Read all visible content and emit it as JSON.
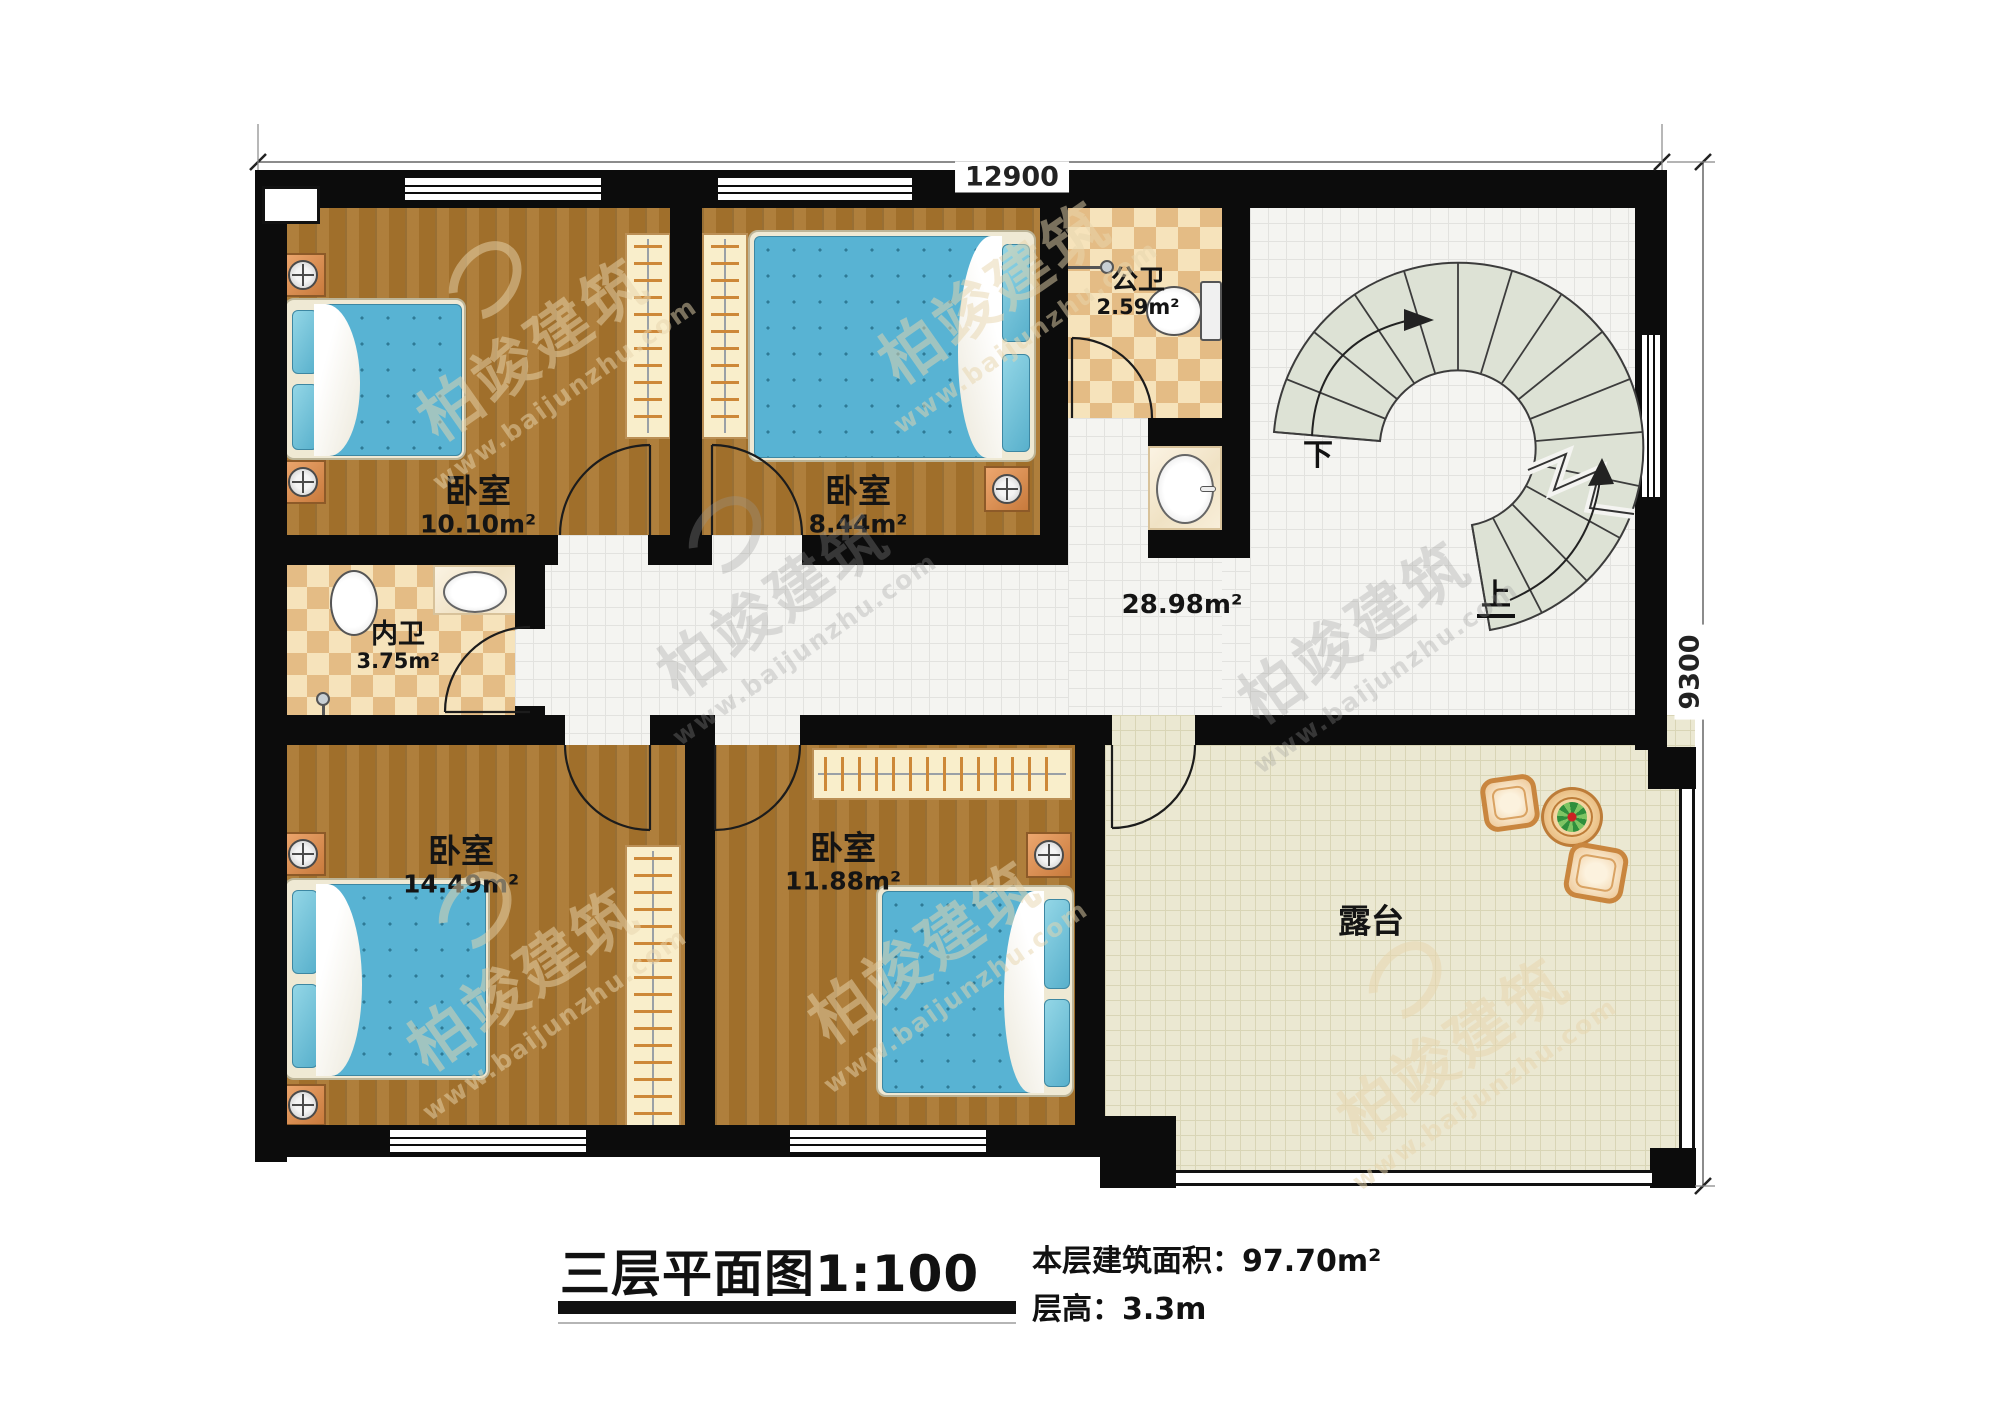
{
  "title_block": {
    "title": "三层平面图1:100",
    "area_line": "本层建筑面积：97.70m²",
    "height_line": "层高：3.3m"
  },
  "dimensions": {
    "top": "12900",
    "right": "9300"
  },
  "rooms": {
    "bedroom_tl": {
      "name": "卧室",
      "area": "10.10m²"
    },
    "bedroom_tm": {
      "name": "卧室",
      "area": "8.44m²"
    },
    "public_bath": {
      "name": "公卫",
      "area": "2.59m²"
    },
    "inner_bath": {
      "name": "内卫",
      "area": "3.75m²"
    },
    "bedroom_bl": {
      "name": "卧室",
      "area": "14.49m²"
    },
    "bedroom_bm": {
      "name": "卧室",
      "area": "11.88m²"
    },
    "hall": {
      "area": "28.98m²"
    },
    "terrace": {
      "name": "露台"
    }
  },
  "stairs": {
    "down": "下",
    "up": "上"
  },
  "watermark": {
    "brand": "柏竣建筑",
    "url": "www.baijunzhu.com"
  }
}
